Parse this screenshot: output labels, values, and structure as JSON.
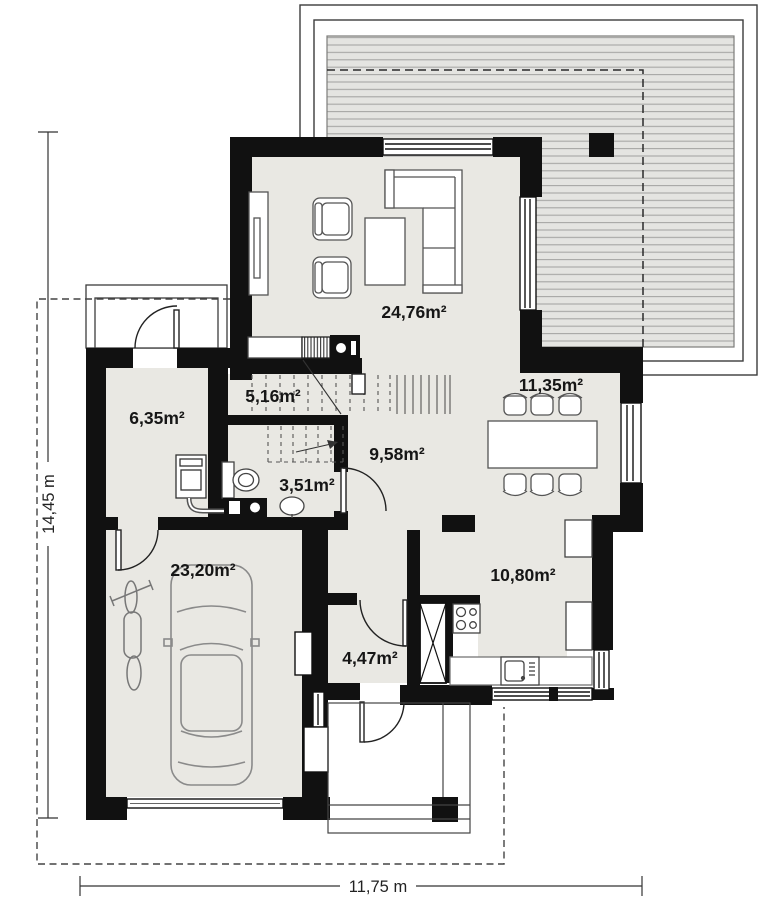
{
  "plan": {
    "rooms": {
      "living": {
        "label": "24,76m²"
      },
      "dining": {
        "label": "11,35m²"
      },
      "kitchen": {
        "label": "10,80m²"
      },
      "hall": {
        "label": "9,58m²"
      },
      "stairs": {
        "label": "5,16m²"
      },
      "bathroom": {
        "label": "3,51m²"
      },
      "utility": {
        "label": "6,35m²"
      },
      "garage": {
        "label": "23,20m²"
      },
      "vestibule": {
        "label": "4,47m²"
      }
    },
    "dimensions": {
      "vertical": "14,45 m",
      "horizontal": "11,75 m"
    },
    "colors": {
      "wall": "#111111",
      "floor": "#e9e8e3",
      "deck_fill": "#e4e4e1",
      "deck_line": "#a6a6a4",
      "outline": "#3c3c3c"
    }
  }
}
